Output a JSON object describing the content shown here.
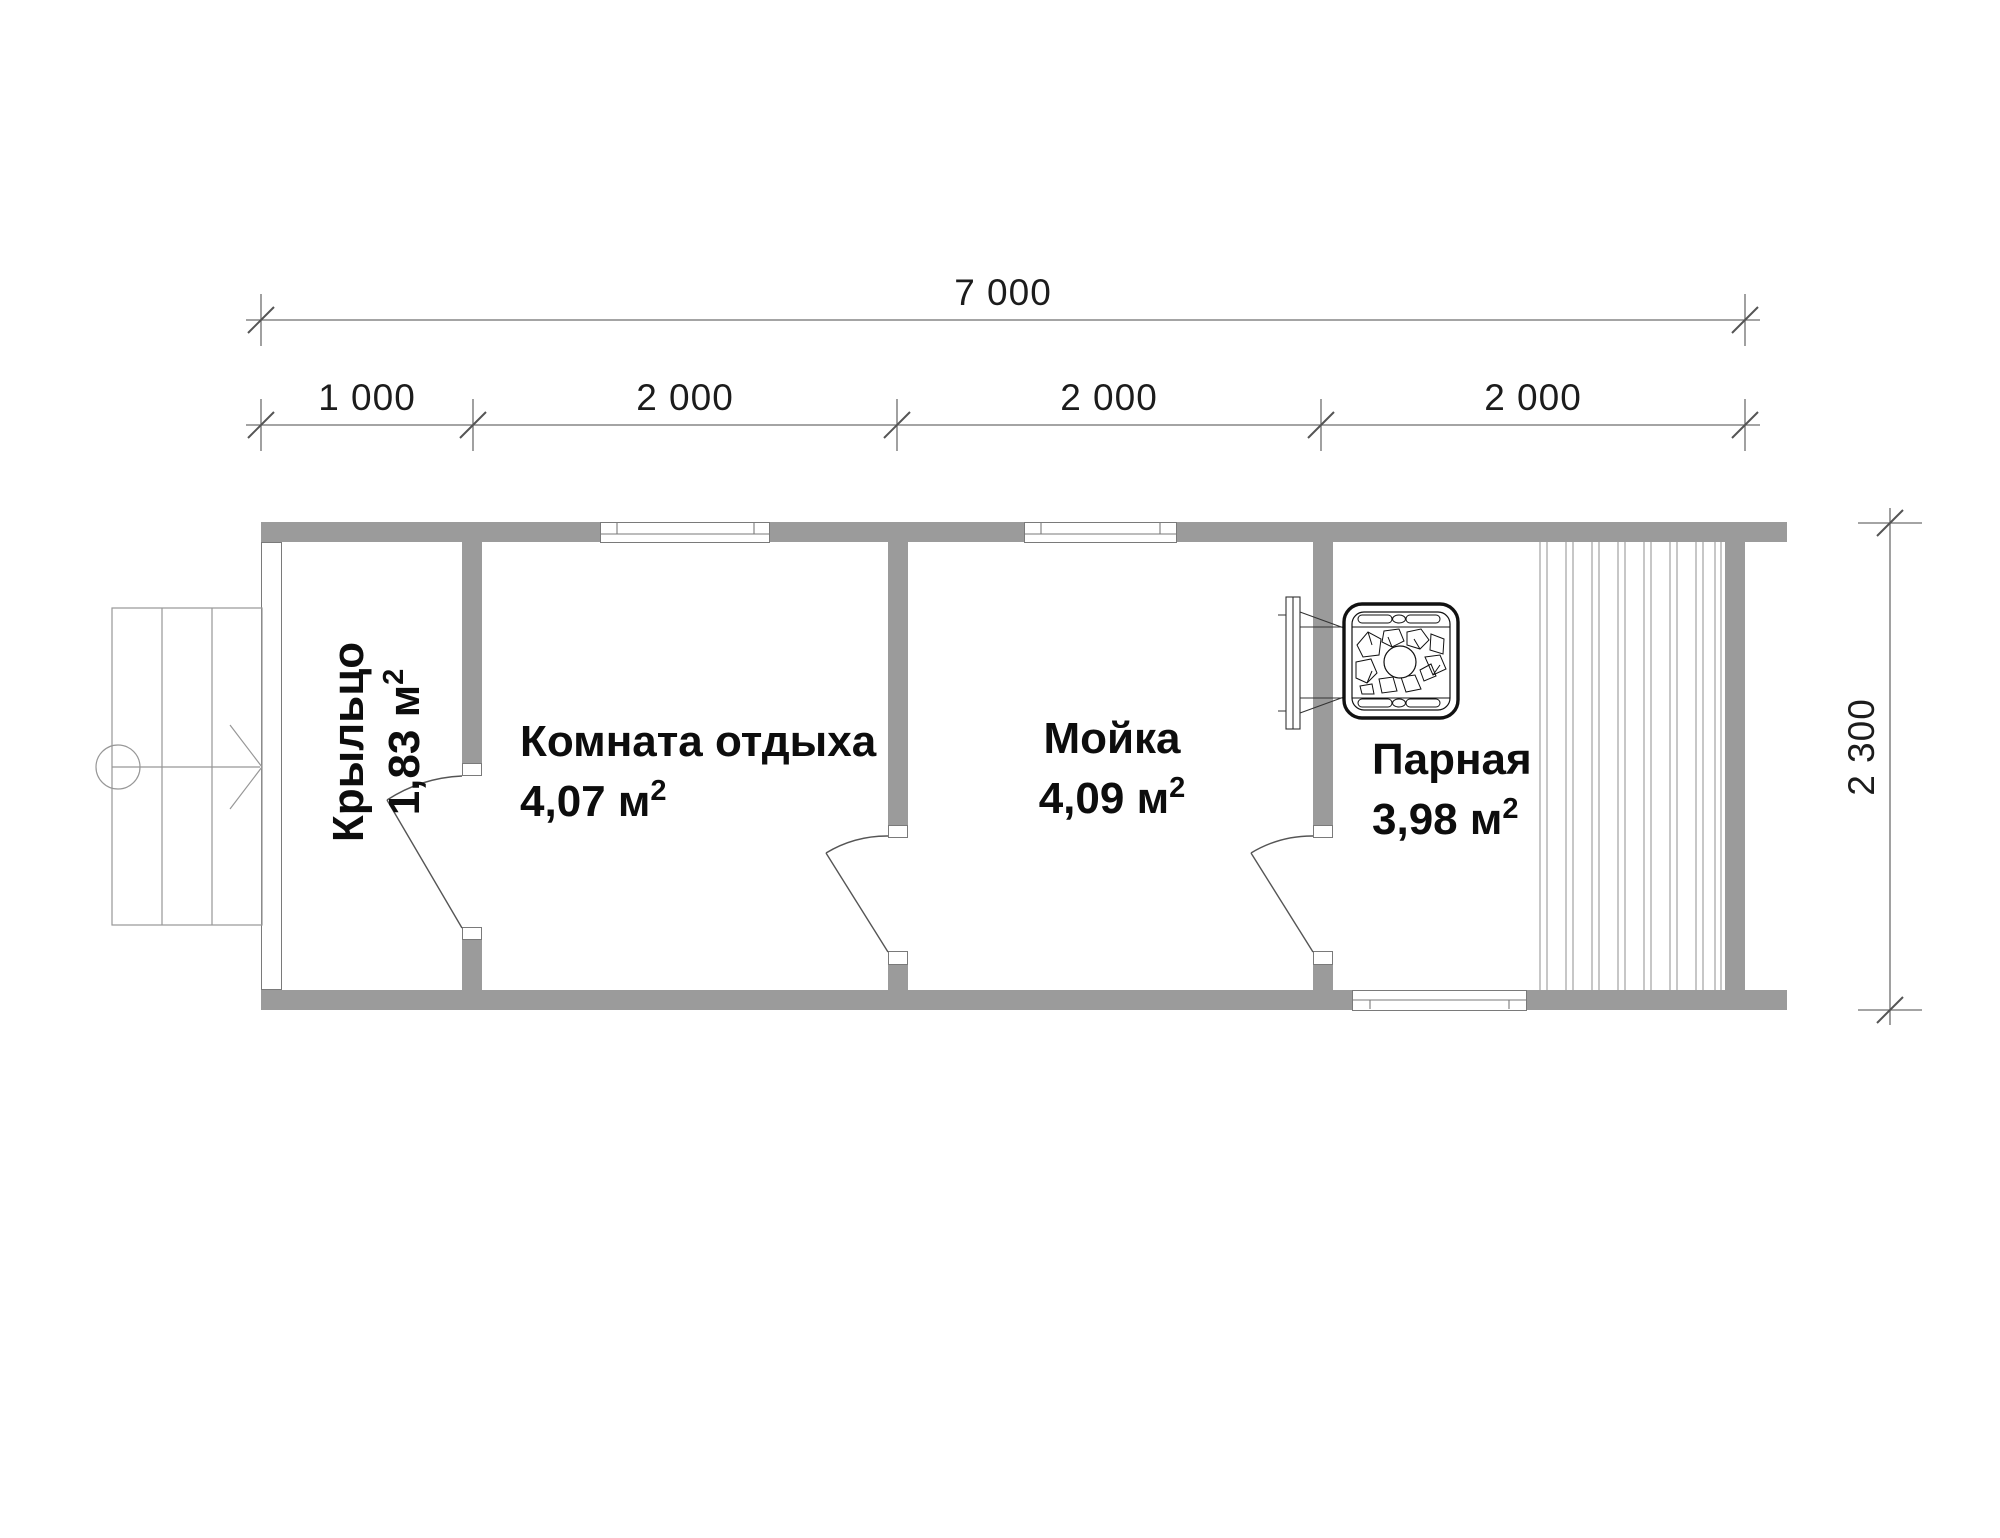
{
  "dimensions": {
    "total_width": "7 000",
    "segments": [
      "1 000",
      "2 000",
      "2 000",
      "2 000"
    ],
    "height": "2 300"
  },
  "rooms": [
    {
      "name": "Крыльцо",
      "area": "1,83 м",
      "sup": "2"
    },
    {
      "name": "Комната отдыха",
      "area": "4,07 м",
      "sup": "2"
    },
    {
      "name": "Мойка",
      "area": "4,09 м",
      "sup": "2"
    },
    {
      "name": "Парная",
      "area": "3,98 м",
      "sup": "2"
    }
  ],
  "icons": {
    "stove": "sauna-stove-icon",
    "stairs": "porch-steps-icon",
    "arrow": "entry-direction-arrow-icon",
    "benches": "bench-slats-icon"
  },
  "colors": {
    "wall": "#9b9b9b",
    "thin_line": "#777777",
    "dim_line": "#6e6e6e",
    "text": "#111111",
    "background": "#ffffff"
  }
}
